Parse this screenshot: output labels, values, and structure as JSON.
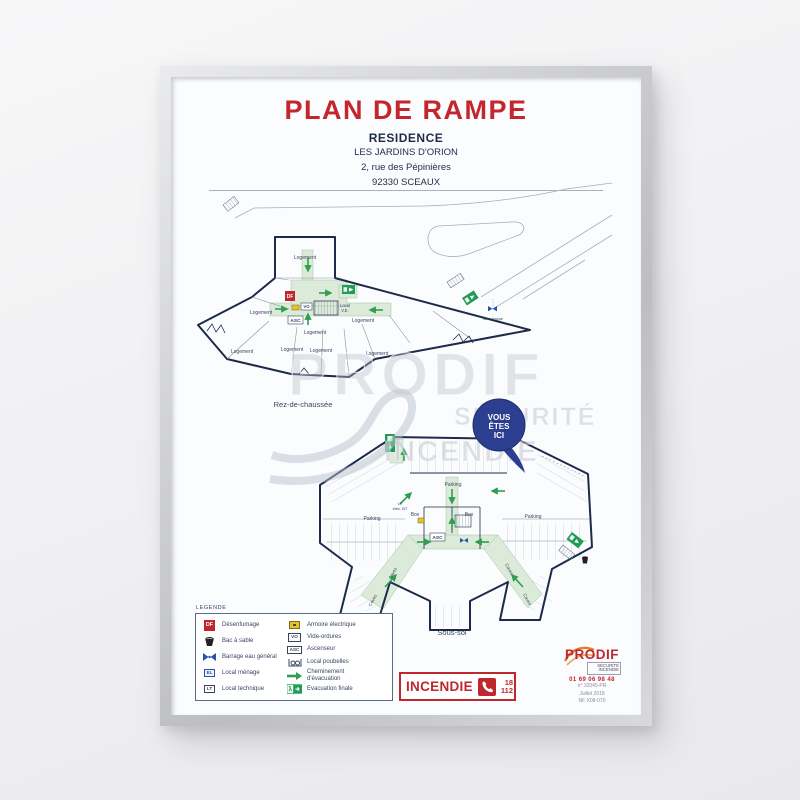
{
  "poster": {
    "title": "PLAN DE RAMPE",
    "building_type": "RESIDENCE",
    "building_name": "LES JARDINS D'ORION",
    "address_street": "2, rue des Pépinières",
    "address_city": "92330 SCEAUX"
  },
  "floors": {
    "ground": {
      "name": "Rez-de-chaussée"
    },
    "basement": {
      "name": "Sous-sol"
    }
  },
  "plan_labels": {
    "logement": "Logement",
    "parking": "Parking",
    "box": "Box",
    "caves": "Caves",
    "asc": "ASC",
    "vo": "VO",
    "df": "DF",
    "local_ve1": "Local",
    "local_ve2": "V.E.",
    "lt_elec_1": "LT",
    "lt_elec_2": "élec. BT",
    "sous_trappe": "sous trappe"
  },
  "you_are_here": {
    "line1": "VOUS",
    "line2": "ÊTES",
    "line3": "ICI"
  },
  "legend": {
    "title": "LEGENDE",
    "items_left": [
      {
        "icon": "df-box-icon",
        "icon_text": "DF",
        "label": "Désenfumage"
      },
      {
        "icon": "sand-bucket-icon",
        "label": "Bac à sable"
      },
      {
        "icon": "water-valve-icon",
        "label": "Barrage eau général"
      },
      {
        "icon": "cleaning-room-icon",
        "icon_text": "EL",
        "label": "Local ménage"
      },
      {
        "icon": "technical-room-icon",
        "icon_text": "LT",
        "label": "Local technique"
      }
    ],
    "items_right": [
      {
        "icon": "electrical-cabinet-icon",
        "label": "Armoire électrique"
      },
      {
        "icon": "garbage-chute-icon",
        "icon_text": "VO",
        "label": "Vide-ordures"
      },
      {
        "icon": "elevator-icon",
        "icon_text": "ASC",
        "label": "Ascenseur"
      },
      {
        "icon": "bin-room-icon",
        "label": "Local poubelles"
      },
      {
        "icon": "evacuation-path-icon",
        "label": "Cheminement d'évacuation"
      },
      {
        "icon": "final-exit-icon",
        "label": "Evacuation finale"
      }
    ]
  },
  "emergency": {
    "label": "INCENDIE",
    "number1": "18",
    "number2": "112"
  },
  "brand": {
    "name": "PRODIF",
    "tagline1": "SECURITE",
    "tagline2": "INCENDIE",
    "phone": "01 69 06 98 48",
    "ref1": "n° 32045-PR",
    "ref2": "Juillet 2018",
    "ref3": "NF X08-070"
  },
  "watermark": {
    "line1": "PRODIF",
    "line2": "SÉCURITÉ",
    "line3": "INCENDIE"
  },
  "colors": {
    "accent_red": "#c0272d",
    "plan_navy": "#1e2a4a",
    "evac_green": "#2f9e4e",
    "balloon_blue": "#2b3e8f"
  }
}
